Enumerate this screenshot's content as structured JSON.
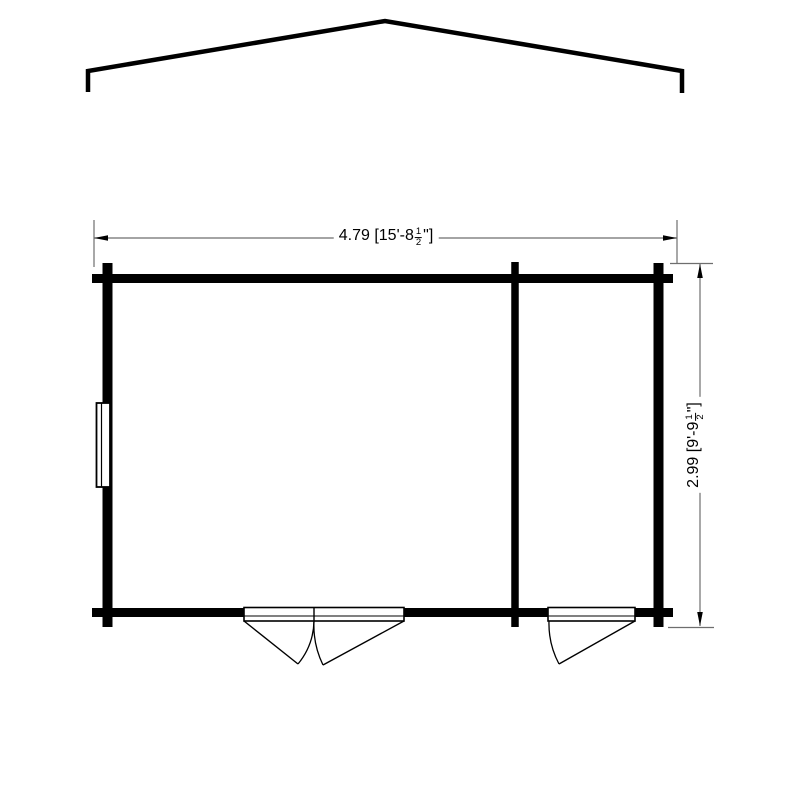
{
  "drawing": {
    "background_color": "#ffffff",
    "wall_color": "#000000",
    "dimension_line_color": "#6e6e6e"
  },
  "dimensions": {
    "horizontal": {
      "metric_m": "4.79",
      "imperial": "15'-8 1/2\"",
      "prefix": "4.79 [15'-8",
      "frac_num": "1",
      "frac_den": "2",
      "suffix": "\"]",
      "full": "4.79 [15'-8½\"]"
    },
    "vertical": {
      "metric_m": "2.99",
      "imperial": "9'-9 1/2\"",
      "prefix": "2.99 [9'-9",
      "frac_num": "1",
      "frac_den": "2",
      "suffix": "\"]",
      "full": "2.99 [9'-9½\"]"
    }
  }
}
